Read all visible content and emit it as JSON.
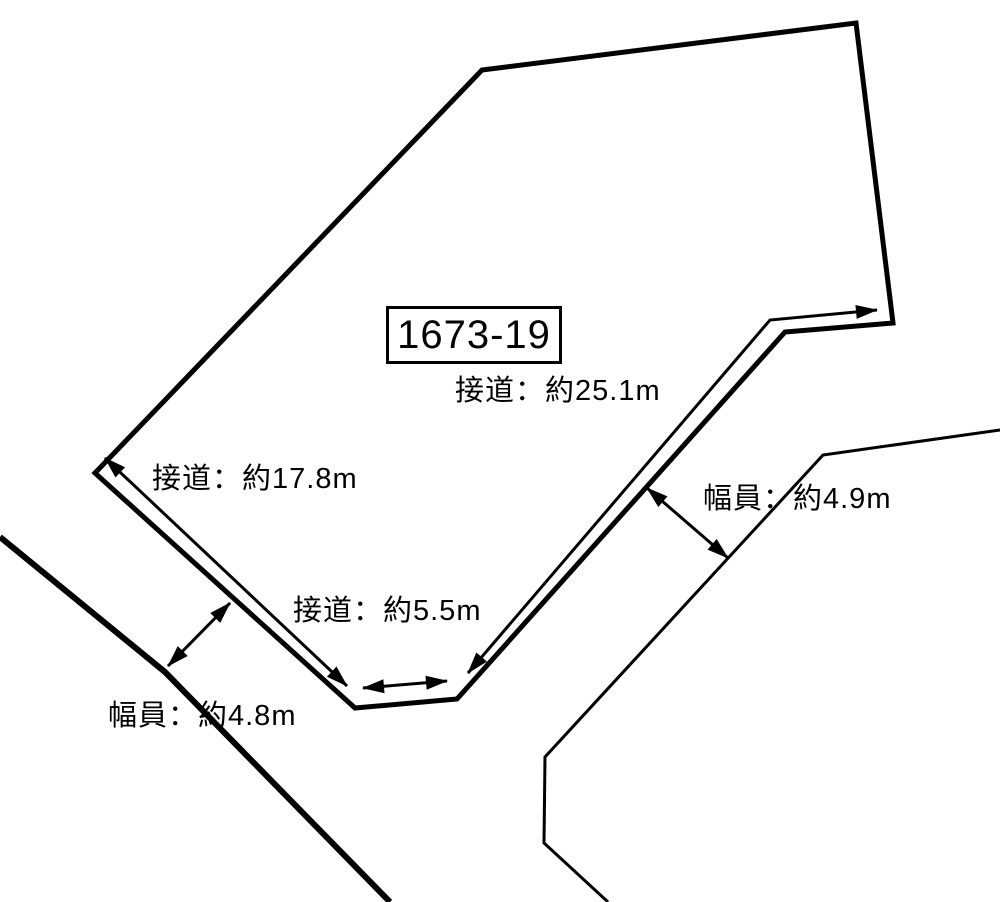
{
  "diagram": {
    "title_parcel_number": "1673-19",
    "colors": {
      "line": "#000000",
      "background": "#ffffff"
    },
    "dimension_labels": {
      "frontage_25_1": {
        "type": "接道",
        "text": "接道：約25.1m"
      },
      "frontage_17_8": {
        "type": "接道",
        "text": "接道：約17.8m"
      },
      "frontage_5_5": {
        "type": "接道",
        "text": "接道：約5.5m"
      },
      "road_width_4_9": {
        "type": "幅員",
        "text": "幅員：約4.9m"
      },
      "road_width_4_8": {
        "type": "幅員",
        "text": "幅員：約4.8m"
      }
    }
  }
}
